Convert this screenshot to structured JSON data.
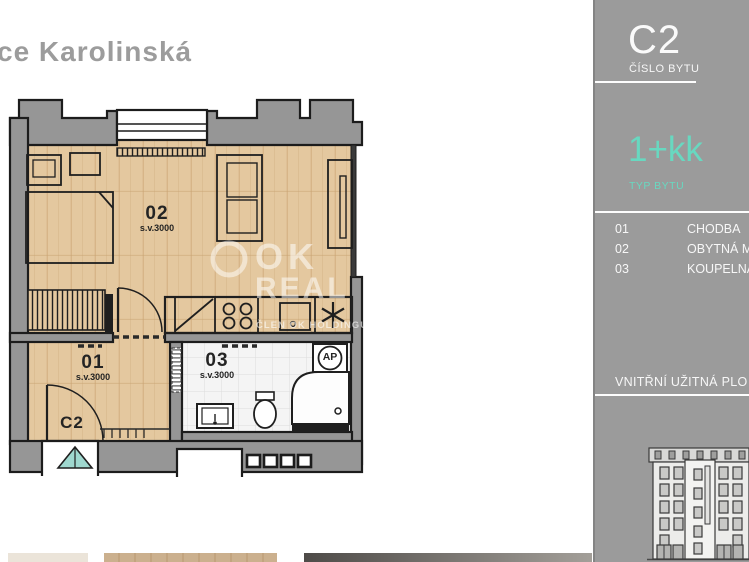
{
  "page": {
    "title_fragment": "ce Karolinská"
  },
  "sidebar": {
    "unit_number": "C2",
    "unit_number_caption": "ČÍSLO BYTU",
    "unit_type": "1+kk",
    "unit_type_caption": "TYP BYTU",
    "rooms": [
      {
        "number": "01",
        "name": "CHODBA"
      },
      {
        "number": "02",
        "name": "OBYTNÁ M"
      },
      {
        "number": "03",
        "name": "KOUPELNA"
      }
    ],
    "area_caption": "VNITŘNÍ UŽITNÁ PLO",
    "accent_color": "#68d8c0",
    "background_color": "#9b9b9b"
  },
  "floorplan": {
    "unit_label": "C2",
    "room_numbers": {
      "living": "02",
      "hall": "01",
      "bath": "03"
    },
    "ceiling_height_note": "s.v.3000",
    "washer_label": "AP",
    "colors": {
      "wood_floor": "#e4c89f",
      "wall_fill": "#969696",
      "bath_tile": "#f4f4f4",
      "entrance_marker": "#9fd8cf"
    }
  },
  "watermark": {
    "word1": "OK",
    "word2": "REAL",
    "tagline": "ČLEN OK HOLDINGU"
  }
}
